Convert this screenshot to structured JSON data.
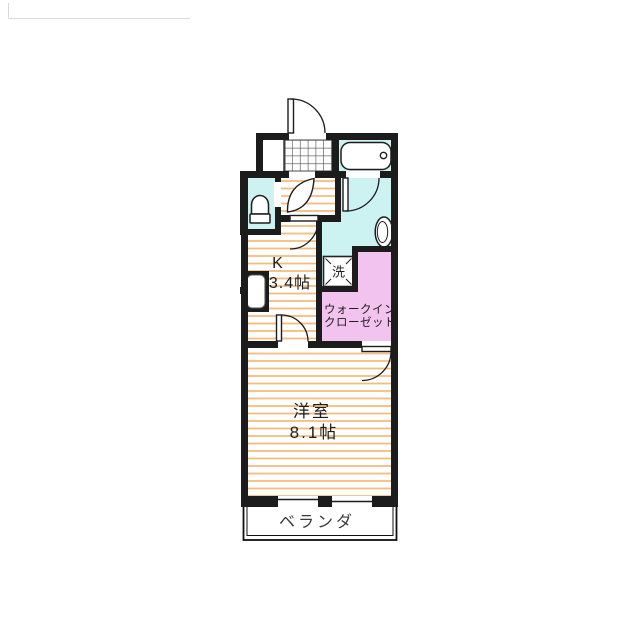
{
  "floorplan": {
    "rooms": {
      "kitchen": {
        "name": "K",
        "area": "3.4帖"
      },
      "western_room": {
        "name": "洋室",
        "area": "8.1帖"
      },
      "walk_in_closet": {
        "name_line1": "ウォークイン",
        "name_line2": "クローゼット"
      },
      "balcony": {
        "name": "ベランダ"
      },
      "washer_symbol": "洗"
    },
    "colors": {
      "wall": "#1c1c1c",
      "wet_area": "#cdf2f2",
      "closet": "#f2c3ee",
      "floor_stripe": "#f4bd7f",
      "crop_mark": "#d9d9d9"
    }
  }
}
